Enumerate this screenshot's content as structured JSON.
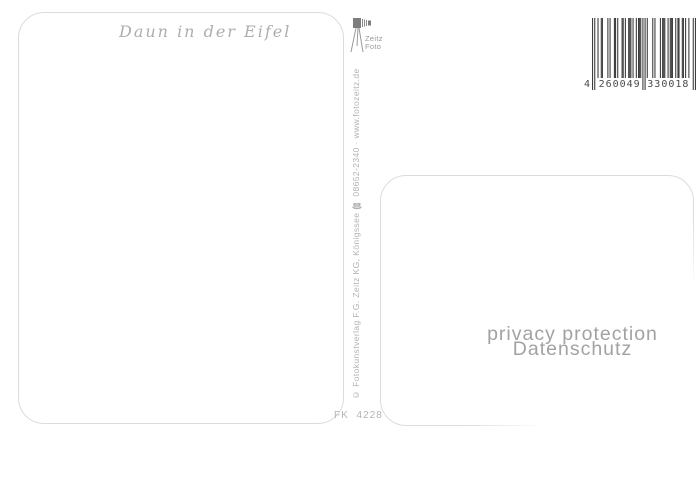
{
  "postcard": {
    "title": "Daun in der Eifel",
    "order_code": "FK 4228",
    "publisher_line": "© Fotokunstverlag F.G. Zeitz KG, Königssee ☎ 08652-2340 · www.fotozeitz.de",
    "logo": {
      "line1": "Zeitz",
      "line2": "Foto"
    }
  },
  "barcode": {
    "number": "4260049330018",
    "display_groups": [
      "4",
      "260049",
      "330018"
    ]
  },
  "privacy": {
    "line1": "privacy protection",
    "line2": "Datenschutz"
  },
  "colors": {
    "card_border": "#dcdcdc",
    "faint_text": "#b2b2b2",
    "privacy_text": "#a2a2a2",
    "barcode_bars": "#3f3f3f"
  }
}
